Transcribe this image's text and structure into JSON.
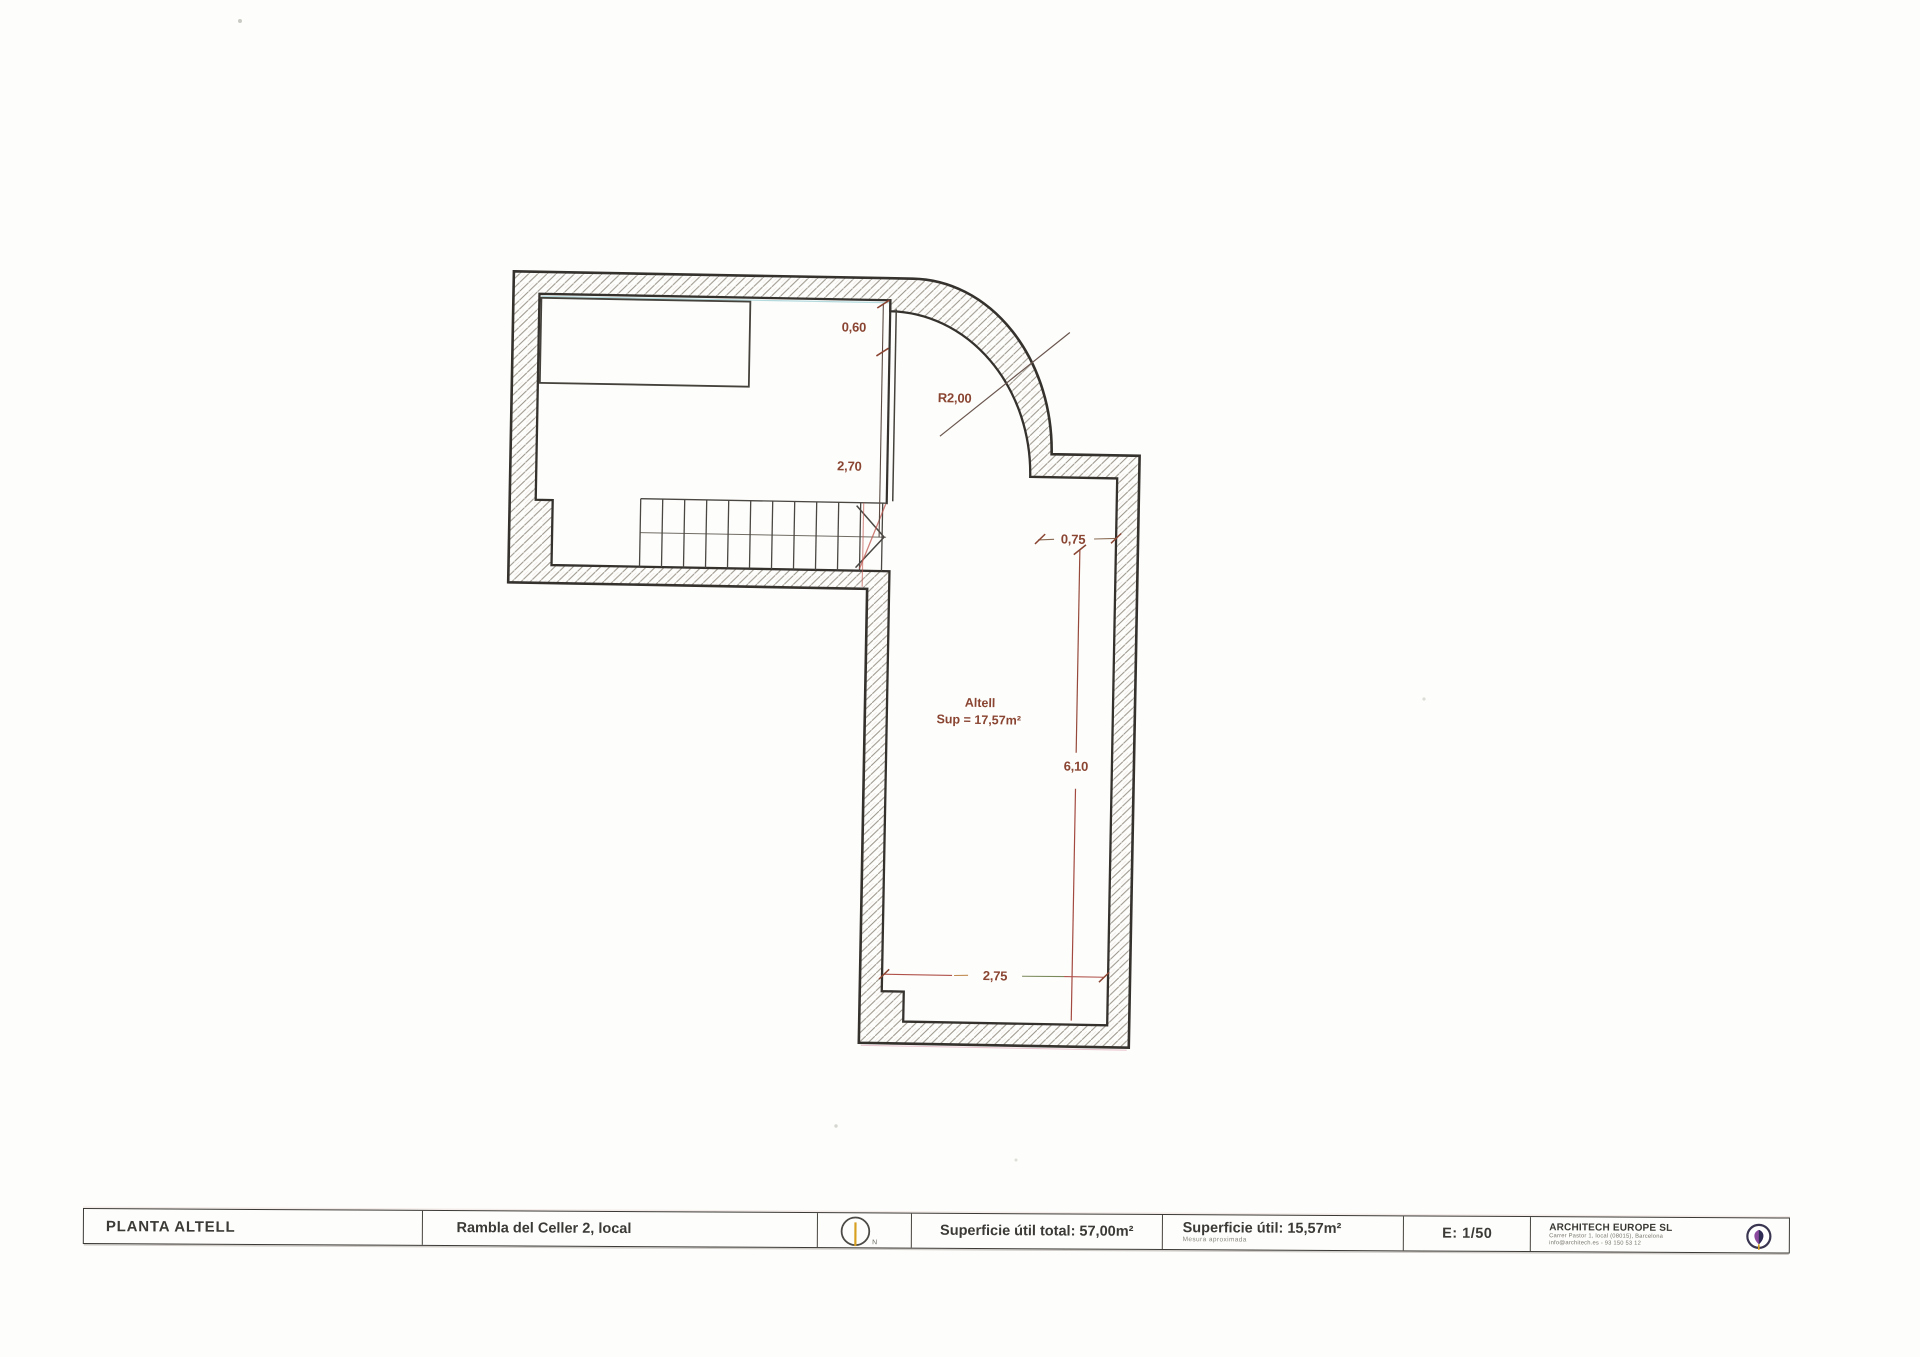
{
  "plan": {
    "room": {
      "name": "Altell",
      "area": "Sup = 17,57m²"
    },
    "dims": {
      "top": "0,60",
      "mid": "2,70",
      "radius": "R2,00",
      "right_top": "0,75",
      "right_height": "6,10",
      "bottom_width": "2,75"
    }
  },
  "title_block": {
    "plan_name": "PLANTA ALTELL",
    "address": "Rambla del Celler 2, local",
    "north_label": "N",
    "total_area": "Superficie útil total: 57,00m²",
    "useful_area": "Superficie útil: 15,57m²",
    "useful_area_note": "Mesura aproximada",
    "scale": "E: 1/50",
    "company": {
      "name": "ARCHITECH EUROPE SL",
      "address": "Carrer Pastor 1, local (08015), Barcelona",
      "contact": "info@architech.es - 93 150 53 12"
    }
  },
  "colors": {
    "ink": "#35322e",
    "dimension_text": "#8a4532",
    "north_line": "#d8a020",
    "logo_purple": "#8b4a9e",
    "logo_navy": "#2e2c54"
  }
}
